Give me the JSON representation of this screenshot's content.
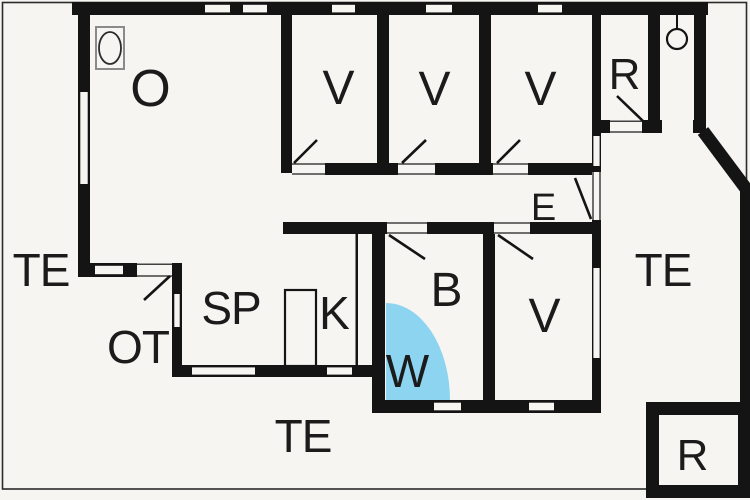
{
  "plan": {
    "type": "floor-plan",
    "colors": {
      "background": "#f7f5f2",
      "wall": "#141414",
      "text": "#1b1b1b",
      "shower_fill": "#8dd4f0",
      "frame": "#2a2a2a"
    },
    "rooms": [
      {
        "id": "living-room",
        "label": "O"
      },
      {
        "id": "bedroom-1",
        "label": "V"
      },
      {
        "id": "bedroom-2",
        "label": "V"
      },
      {
        "id": "bedroom-3",
        "label": "V"
      },
      {
        "id": "storage-top",
        "label": "R"
      },
      {
        "id": "entry-hall",
        "label": "E"
      },
      {
        "id": "terrace-left",
        "label": "TE"
      },
      {
        "id": "entry-porch",
        "label": "OT"
      },
      {
        "id": "dining-area",
        "label": "SP"
      },
      {
        "id": "kitchen",
        "label": "K"
      },
      {
        "id": "bathroom",
        "label": "B"
      },
      {
        "id": "shower",
        "label": "W"
      },
      {
        "id": "bedroom-4",
        "label": "V"
      },
      {
        "id": "terrace-right",
        "label": "TE"
      },
      {
        "id": "terrace-bottom",
        "label": "TE"
      },
      {
        "id": "storage-annex",
        "label": "R"
      }
    ],
    "fixtures": [
      {
        "id": "stove",
        "icon": "stove-icon"
      },
      {
        "id": "ceiling-lamp",
        "icon": "lamp-icon"
      },
      {
        "id": "kitchen-cupboard",
        "icon": "cupboard-icon"
      },
      {
        "id": "shower-quadrant",
        "icon": "shower-icon"
      }
    ]
  }
}
